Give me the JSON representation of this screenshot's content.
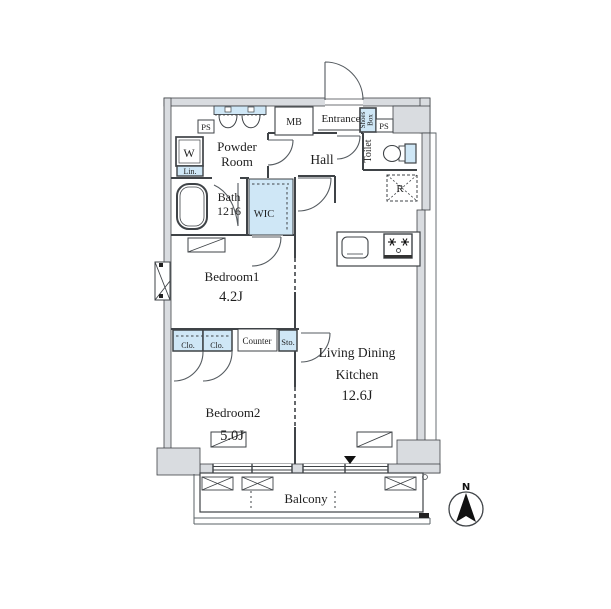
{
  "plan": {
    "colors": {
      "wall": "#d9dce0",
      "fixture_blue": "#cfe7f6",
      "line": "#3f4347",
      "text": "#1e1e1e"
    },
    "top": {
      "ps_left": "PS",
      "mb": "MB",
      "entrance": "Entrance",
      "shoes_line1": "Shoes",
      "shoes_line2": "Box",
      "ps_right": "PS"
    },
    "powder": {
      "line1": "Powder",
      "line2": "Room",
      "washer": "W",
      "linen": "Lin."
    },
    "hall": {
      "label": "Hall"
    },
    "toilet": {
      "label": "Toilet"
    },
    "bath": {
      "line1": "Bath",
      "line2": "1216"
    },
    "wic": {
      "label": "WIC"
    },
    "kitchen": {
      "fridge": "R"
    },
    "bedroom1": {
      "name": "Bedroom1",
      "size": "4.2J"
    },
    "storage": {
      "clo1": "Clo.",
      "clo2": "Clo.",
      "counter": "Counter",
      "sto": "Sto."
    },
    "bedroom2": {
      "name": "Bedroom2",
      "size": "5.0J"
    },
    "ldk": {
      "line1": "Living Dining",
      "line2": "Kitchen",
      "size": "12.6J"
    },
    "balcony": {
      "label": "Balcony"
    },
    "compass": {
      "north": "N"
    }
  }
}
